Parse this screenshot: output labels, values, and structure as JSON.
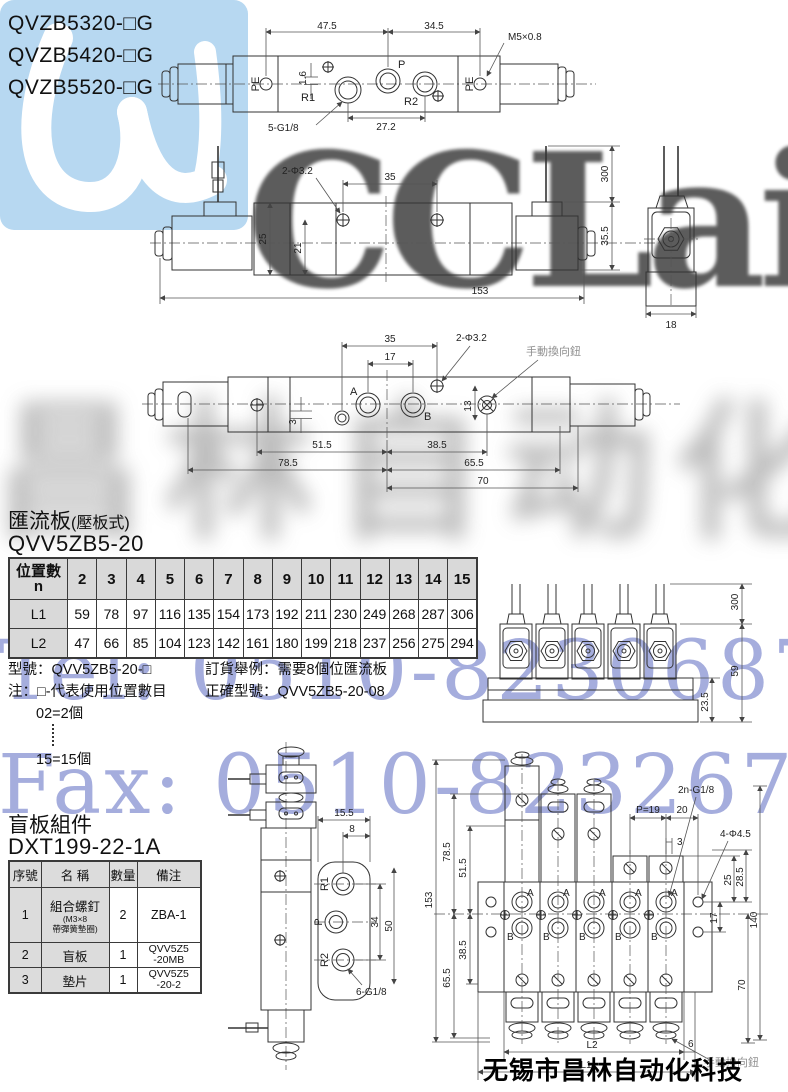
{
  "models": {
    "m1": "QVZB5320-□G",
    "m2": "QVZB5420-□G",
    "m3": "QVZB5520-□G"
  },
  "watermarks": {
    "logo_word": "CCLair",
    "grey_cn": "昌林自动化",
    "tel": "Tel: 0510-82306871",
    "fax": "Fax: 0510-82326771",
    "footer": "无锡市昌林自动化科技",
    "logo_color": "#b7d8f1",
    "blue_color": "#7c87cd"
  },
  "top_drawing": {
    "d47_5": "47.5",
    "d34_5": "34.5",
    "thread": "M5×0.8",
    "pe_left": "PE",
    "pe_right": "PE",
    "r1": "R1",
    "p": "P",
    "r2": "R2",
    "d1_6": "1.6",
    "ports": "5-G1/8",
    "d27_2": "27.2"
  },
  "side_drawing": {
    "holes": "2-Φ3.2",
    "d35": "35",
    "d25": "25",
    "d21": "21",
    "d153": "153",
    "d300": "300",
    "d35_5": "35.5",
    "d18": "18"
  },
  "bottom_drawing": {
    "d35": "35",
    "d17": "17",
    "holes": "2-Φ3.2",
    "manual": "手動換向鈕",
    "a": "A",
    "b": "B",
    "d3": "3",
    "d13": "13",
    "d51_5": "51.5",
    "d38_5": "38.5",
    "d78_5": "78.5",
    "d65_5": "65.5",
    "d70": "70"
  },
  "manifold_section": {
    "heading": "匯流板",
    "heading_note": "(壓板式)",
    "model": "QVV5ZB5-20",
    "table": {
      "corner_top": "位置數",
      "corner_bottom": "n",
      "positions": [
        "2",
        "3",
        "4",
        "5",
        "6",
        "7",
        "8",
        "9",
        "10",
        "11",
        "12",
        "13",
        "14",
        "15"
      ],
      "rows": [
        {
          "label": "L1",
          "values": [
            "59",
            "78",
            "97",
            "116",
            "135",
            "154",
            "173",
            "192",
            "211",
            "230",
            "249",
            "268",
            "287",
            "306"
          ]
        },
        {
          "label": "L2",
          "values": [
            "47",
            "66",
            "85",
            "104",
            "123",
            "142",
            "161",
            "180",
            "199",
            "218",
            "237",
            "256",
            "275",
            "294"
          ]
        }
      ]
    },
    "note_model": "型號：QVV5ZB5-20-□",
    "note_line1": "注：□-代表使用位置數目",
    "note_line2": "02=2個",
    "note_line3": "15=15個",
    "order_line1": "訂貨舉例：需要8個位匯流板",
    "order_line2": "正確型號：QVV5ZB5-20-08"
  },
  "manifold_side_drawing": {
    "d300": "300",
    "d59": "59",
    "d23_5": "23.5"
  },
  "blank_section": {
    "heading": "盲板組件",
    "model": "DXT199-22-1A",
    "table": {
      "h_no": "序號",
      "h_name": "名 稱",
      "h_qty": "數量",
      "h_note": "備注",
      "r1_no": "1",
      "r1_name": "組合螺釘",
      "r1_sub1": "(M3×8",
      "r1_sub2": "帶彈簧墊圈)",
      "r1_qty": "2",
      "r1_note": "ZBA-1",
      "r2_no": "2",
      "r2_name": "盲板",
      "r2_qty": "1",
      "r2_note1": "QVV5Z5",
      "r2_note2": "-20MB",
      "r3_no": "3",
      "r3_name": "墊片",
      "r3_qty": "1",
      "r3_note1": "QVV5Z5",
      "r3_note2": "-20-2"
    }
  },
  "single_front_drawing": {
    "d15_5": "15.5",
    "d8": "8",
    "r1": "R1",
    "p": "P",
    "r2": "R2",
    "d34": "34",
    "d50": "50",
    "ports": "6-G1/8"
  },
  "manifold_front_drawing": {
    "d153": "153",
    "d78_5": "78.5",
    "d51_5": "51.5",
    "d38_5": "38.5",
    "d65_5": "65.5",
    "pitch": "P=19",
    "d20": "20",
    "d3": "3",
    "ports": "2n-G1/8",
    "holes": "4-Φ4.5",
    "d25": "25",
    "d28_5": "28.5",
    "d17": "17",
    "d140": "140",
    "d70": "70",
    "d6": "6",
    "l1": "L1",
    "l2": "L2",
    "manual": "手動換向鈕",
    "port_a": "A",
    "port_b": "B"
  }
}
